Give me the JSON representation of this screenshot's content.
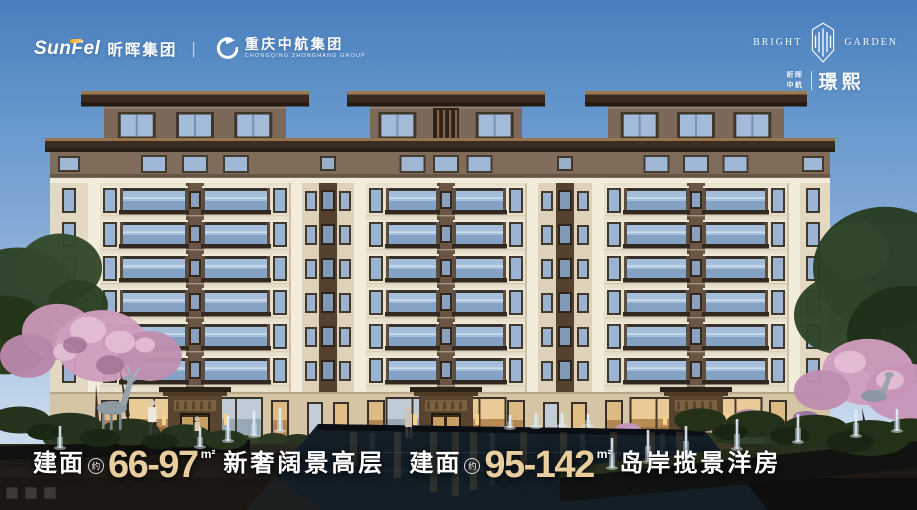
{
  "brand_bar": {
    "sunfel": {
      "latin": "SunFel",
      "cn": "昕晖集团"
    },
    "divider": "|",
    "partner": {
      "cn": "重庆中航集团",
      "en": "CHONGQING ZHONGHANG GROUP"
    }
  },
  "project_logo": {
    "en_left": "BRIGHT",
    "en_right": "GARDEN",
    "cn_small_top": "昕晖",
    "cn_small_bottom": "中航",
    "cn_name": "璟熙"
  },
  "tagline": {
    "accent_color": "#e8cd9e",
    "text_color": "#ffffff",
    "segments": [
      {
        "label": "建面",
        "approx": "约",
        "range": "66-97",
        "unit": "m²",
        "desc": "新奢阔景高层"
      },
      {
        "label": "建面",
        "approx": "约",
        "range": "95-142",
        "unit": "m²",
        "desc": "岛岸揽景洋房"
      }
    ]
  },
  "colors": {
    "sky_top": "#4a80bf",
    "sky_horizon": "#cfdded",
    "building_cream": "#e9e0cc",
    "building_brown": "#7c695a",
    "roof_brown": "#3a2c21",
    "glass_blue": "#9db8d8",
    "blossom_pink": "#cf9dbd",
    "water_dark": "#15222b",
    "logo_accent_orange": "#f5a623"
  },
  "icons": {
    "partner_icon": "phoenix-swirl-icon",
    "project_icon": "garden-emblem-icon"
  }
}
